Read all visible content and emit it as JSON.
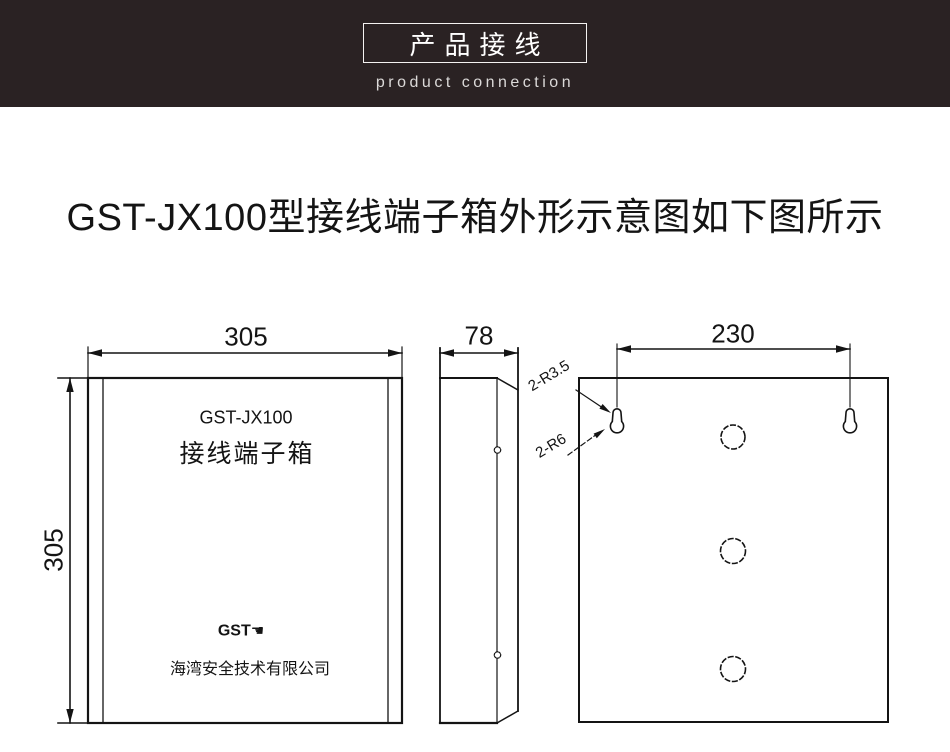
{
  "header": {
    "title_cn": "产品接线",
    "title_en": "product connection",
    "bg_color": "#2a2223",
    "border_color": "#f4f2f1"
  },
  "page": {
    "heading": "GST-JX100型接线端子箱外形示意图如下图所示"
  },
  "diagram": {
    "front_view": {
      "width_label": "305",
      "height_label": "305",
      "model": "GST-JX100",
      "product_name": "接线端子箱",
      "logo_text": "GST",
      "logo_mark": "☚",
      "company": "海湾安全技术有限公司"
    },
    "side_view": {
      "depth_label": "78"
    },
    "back_view": {
      "hole_spacing_label": "230",
      "slot_small_radius_label": "2-R3.5",
      "slot_large_radius_label": "2-R6"
    },
    "line_color": "#141414"
  }
}
